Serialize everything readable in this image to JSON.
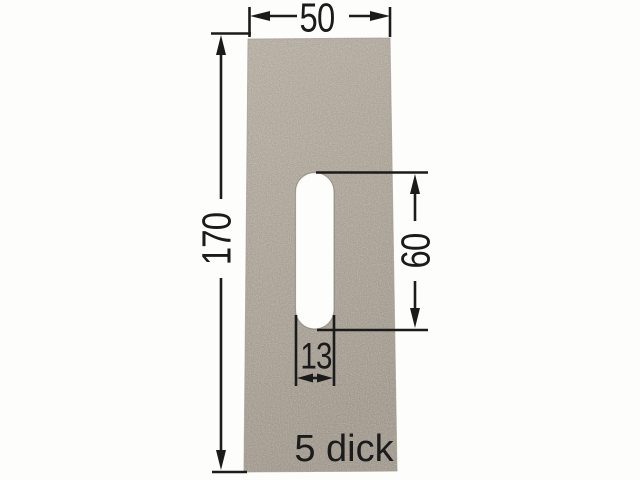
{
  "drawing": {
    "labels": {
      "plate_width": "50",
      "plate_height": "170",
      "slot_height": "60",
      "slot_width": "13",
      "thickness": "5 dick"
    },
    "colors": {
      "background": "#fdfdfb",
      "plate_base": "#a9a093",
      "plate_light": "#b6ada0",
      "plate_dark": "#9a9185",
      "plate_edge": "#8f887c",
      "slot": "#fdfdfb",
      "line": "#1b1b1b",
      "text": "#1b1b1b"
    }
  }
}
